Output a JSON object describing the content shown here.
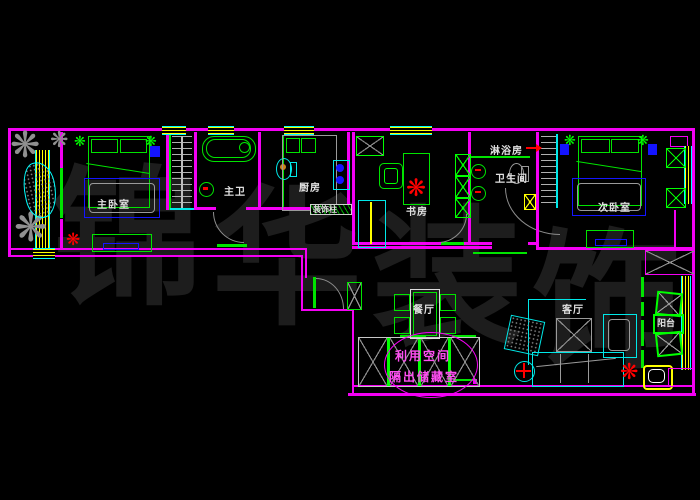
{
  "drawing": {
    "type": "CAD apartment floor plan",
    "background": "#000000"
  },
  "watermark": {
    "c1": "锦",
    "c2": "华",
    "c3": "装",
    "c4": "饰",
    "full_text": "锦华装饰"
  },
  "labels": {
    "master_bedroom": "主卧室",
    "master_bath": "主卫",
    "kitchen": "厨房",
    "deco_column": "装饰柱",
    "study": "书房",
    "shower_room": "淋浴房",
    "bathroom": "卫生间",
    "second_bedroom": "次卧室",
    "dining_room": "餐厅",
    "living_room": "客厅",
    "balcony": "阳台"
  },
  "annotation": {
    "line1": "利用空间",
    "line2": "隔出储藏室"
  },
  "colors": {
    "wall": "#ff00ff",
    "furniture_green": "#00ff00",
    "fixture_cyan": "#00ffff",
    "accent_blue": "#0000ff",
    "window_yellow": "#ffff00",
    "alert_red": "#ff0000",
    "door_arc_gray": "#8d8d8d",
    "label_text": "#e0e0e0",
    "annotation_pink": "#ff4df2",
    "watermark_gray": "#1d1d1d"
  }
}
